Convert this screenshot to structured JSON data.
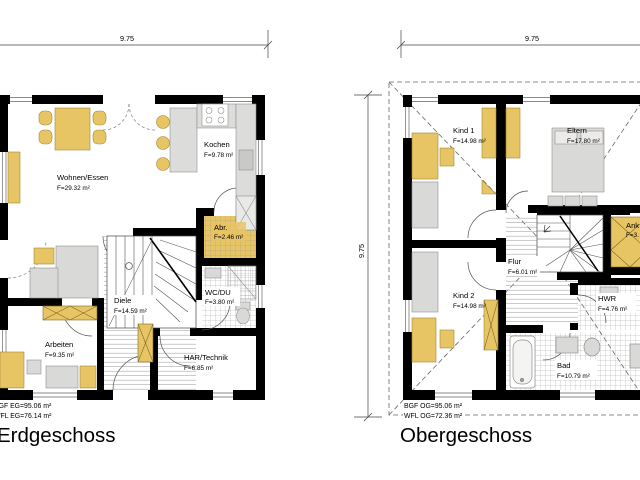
{
  "colors": {
    "wall": "#000000",
    "furniture_wood": "#e7c464",
    "furniture_gray": "#d9d9d7",
    "counter_gray": "#dcdcda",
    "hatch": "#9a9a9a",
    "dash": "#666666"
  },
  "eg": {
    "dim_top": "9.75",
    "rooms": {
      "wohnen": {
        "name": "Wohnen/Essen",
        "area": "F=29.32 m²"
      },
      "kochen": {
        "name": "Kochen",
        "area": "F=9.78 m²"
      },
      "abr": {
        "name": "Abr.",
        "area": "F=2.46 m²"
      },
      "diele": {
        "name": "Diele",
        "area": "F=14.59 m²"
      },
      "wc": {
        "name": "WC/DU",
        "area": "F=3.80 m²"
      },
      "arbeiten": {
        "name": "Arbeiten",
        "area": "F=9.35 m²"
      },
      "har": {
        "name": "HAR/Technik",
        "area": "F=6.85 m²"
      }
    },
    "stats": {
      "bgf": "BGF EG=95.06 m²",
      "wfl": "WFL EG=76.14 m²"
    },
    "title": "Erdgeschoss"
  },
  "og": {
    "dim_top": "9.75",
    "dim_left": "9.75",
    "rooms": {
      "kind1": {
        "name": "Kind 1",
        "area": "F=14.98 m²"
      },
      "eltern": {
        "name": "Eltern",
        "area": "F=17.80 m²"
      },
      "ank": {
        "name": "Ank",
        "area": "F=3."
      },
      "flur": {
        "name": "Flur",
        "area": "F=6.01 m²"
      },
      "kind2": {
        "name": "Kind 2",
        "area": "F=14.98 m²"
      },
      "hwr": {
        "name": "HWR",
        "area": "F=4.76 m²"
      },
      "bad": {
        "name": "Bad",
        "area": "F=10.79 m²"
      }
    },
    "stats": {
      "bgf": "BGF OG=95.06 m²",
      "wfl": "WFL OG=72.36 m²"
    },
    "title": "Obergeschoss"
  }
}
